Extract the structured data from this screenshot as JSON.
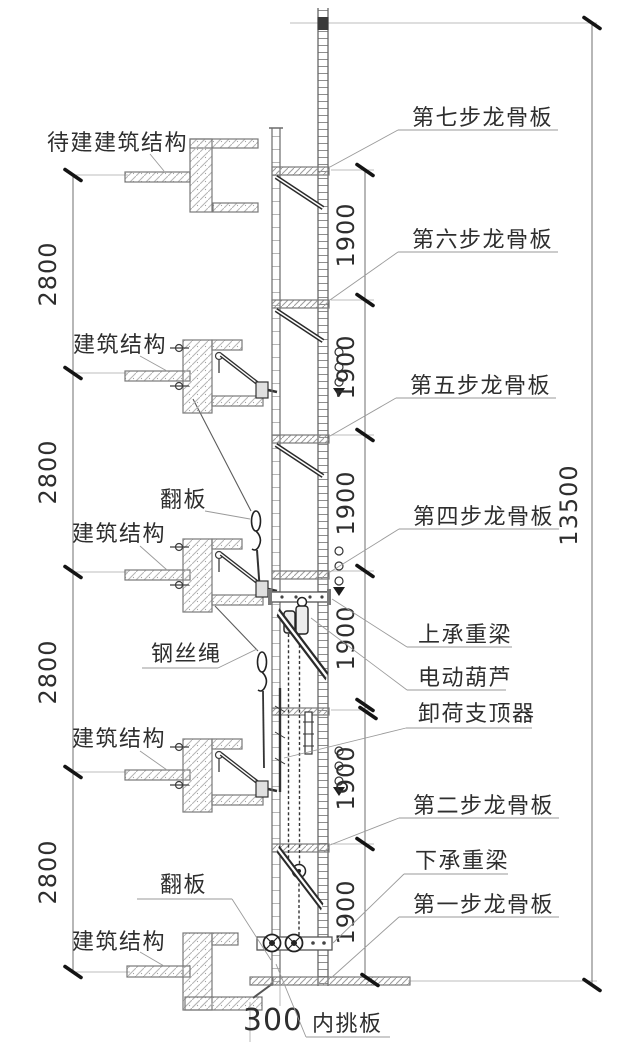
{
  "drawing_type": "attached-lifting-scaffold-elevation",
  "labels": {
    "right": [
      "第七步龙骨板",
      "第六步龙骨板",
      "第五步龙骨板",
      "第四步龙骨板",
      "上承重梁",
      "电动葫芦",
      "卸荷支顶器",
      "第二步龙骨板",
      "下承重梁",
      "第一步龙骨板"
    ],
    "left": [
      "待建建筑结构",
      "建筑结构",
      "翻板",
      "建筑结构",
      "钢丝绳",
      "建筑结构",
      "翻板",
      "建筑结构",
      "内挑板"
    ]
  },
  "dimensions": {
    "story_heights": [
      "2800",
      "2800",
      "2800",
      "2800"
    ],
    "step_heights": [
      "1900",
      "1900",
      "1900",
      "1900",
      "1900",
      "1900"
    ],
    "total_height": "13500",
    "bottom_offset": "300"
  },
  "colors": {
    "background": "#ffffff",
    "structure_line": "#787878",
    "hardware_dark": "#1c1c1c",
    "text": "#2e2e2e",
    "leader": "#9a9a9a",
    "hatch": "#b5b5b5"
  }
}
